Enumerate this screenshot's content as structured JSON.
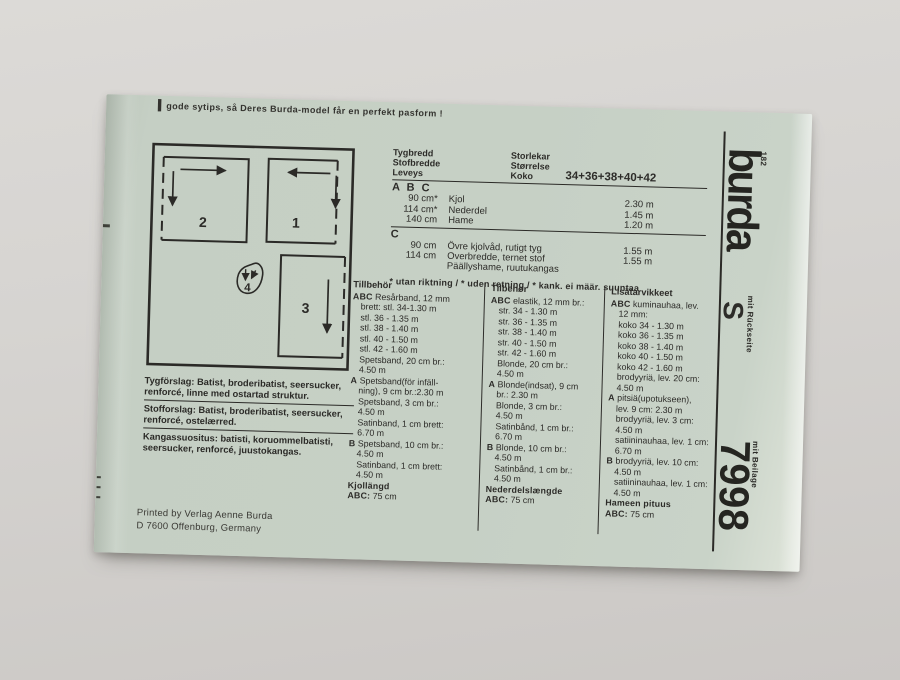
{
  "colors": {
    "background": "#d4d2cf",
    "paper": "#c6d0c5",
    "ink": "#2b2a27"
  },
  "top_note": {
    "lead_mark": "▍",
    "text": "gode sytips, så Deres Burda-model får en perfekt pasform !"
  },
  "layout_diagram": {
    "pieces": [
      "1",
      "2",
      "3",
      "4"
    ]
  },
  "fabric_table": {
    "header_left": [
      "Tygbredd",
      "Stofbredde",
      "Leveys"
    ],
    "header_right": [
      "Storlekar",
      "Størrelse",
      "Koko"
    ],
    "sizes": "34+36+38+40+42",
    "sections": [
      {
        "label": "A B C",
        "rows": [
          [
            "90 cm*",
            "Kjol",
            "2.30 m"
          ],
          [
            "114 cm*",
            "Nederdel",
            "1.45 m"
          ],
          [
            "140 cm",
            "Hame",
            "1.20 m"
          ]
        ]
      },
      {
        "label": "C",
        "rows": [
          [
            "90 cm",
            "Övre kjolvåd, rutigt tyg",
            "1.55 m"
          ],
          [
            "114 cm",
            "Overbredde, ternet stof",
            "1.55 m"
          ],
          [
            "",
            "Päällyshame, ruutukangas",
            ""
          ]
        ]
      }
    ],
    "footnote": "* utan riktning / * uden retning / * kank. ei määr. suuntaa"
  },
  "notions_columns": [
    {
      "title": "Tillbehör",
      "lines": [
        {
          "b": "ABC",
          "t": "Resårband, 12 mm"
        },
        {
          "t": "brett: stl. 34-1.30 m"
        },
        {
          "t": "stl. 36 - 1.35 m"
        },
        {
          "t": "stl. 38 - 1.40 m"
        },
        {
          "t": "stl. 40 - 1.50 m"
        },
        {
          "t": "stl. 42 - 1.60 m"
        },
        {
          "t": "Spetsband, 20 cm br.:"
        },
        {
          "t": "4.50 m"
        },
        {
          "b": "A",
          "t": "Spetsband(för infäll-"
        },
        {
          "t": "ning), 9 cm br.:2.30 m"
        },
        {
          "t": "Spetsband, 3 cm br.:"
        },
        {
          "t": "4.50 m"
        },
        {
          "t": "Satinband, 1 cm brett:"
        },
        {
          "t": "6.70 m"
        },
        {
          "b": "B",
          "t": "Spetsband, 10 cm br.:"
        },
        {
          "t": "4.50 m"
        },
        {
          "t": "Satinband, 1 cm brett:"
        },
        {
          "t": "4.50 m"
        },
        {
          "b": "Kjollängd",
          "t": ""
        },
        {
          "b": "ABC:",
          "t": "75 cm"
        }
      ]
    },
    {
      "title": "Tilbehør",
      "lines": [
        {
          "b": "ABC",
          "t": "elastik, 12 mm br.:"
        },
        {
          "t": "str. 34 - 1.30 m"
        },
        {
          "t": "str. 36 - 1.35 m"
        },
        {
          "t": "str. 38 - 1.40 m"
        },
        {
          "t": "str. 40 - 1.50 m"
        },
        {
          "t": "str. 42 - 1.60 m"
        },
        {
          "t": "Blonde, 20 cm br.:"
        },
        {
          "t": "4.50 m"
        },
        {
          "b": "A",
          "t": "Blonde(indsat), 9 cm"
        },
        {
          "t": "br.: 2.30 m"
        },
        {
          "t": "Blonde, 3 cm br.:"
        },
        {
          "t": "4.50 m"
        },
        {
          "t": "Satinbånd, 1 cm br.:"
        },
        {
          "t": "6.70 m"
        },
        {
          "b": "B",
          "t": "Blonde, 10 cm br.:"
        },
        {
          "t": "4.50 m"
        },
        {
          "t": "Satinbånd, 1 cm br.:"
        },
        {
          "t": "4.50 m"
        },
        {
          "b": "Nederdelslængde",
          "t": ""
        },
        {
          "b": "ABC:",
          "t": "75 cm"
        }
      ]
    },
    {
      "title": "Lisätarvikkeet",
      "lines": [
        {
          "b": "ABC",
          "t": "kuminauhaa, lev."
        },
        {
          "t": "12 mm:"
        },
        {
          "t": "koko 34 - 1.30 m"
        },
        {
          "t": "koko 36 - 1.35 m"
        },
        {
          "t": "koko 38 - 1.40 m"
        },
        {
          "t": "koko 40 - 1.50 m"
        },
        {
          "t": "koko 42 - 1.60 m"
        },
        {
          "t": "brodyyriä, lev. 20 cm:"
        },
        {
          "t": "4.50 m"
        },
        {
          "b": "A",
          "t": "pitsiä(upotukseen),"
        },
        {
          "t": "lev. 9 cm: 2.30 m"
        },
        {
          "t": "brodyyriä, lev. 3 cm:"
        },
        {
          "t": "4.50 m"
        },
        {
          "t": "satiininauhaa, lev. 1 cm:"
        },
        {
          "t": "6.70 m"
        },
        {
          "b": "B",
          "t": "brodyyriä, lev. 10 cm:"
        },
        {
          "t": "4.50 m"
        },
        {
          "t": "satiininauhaa, lev. 1 cm:"
        },
        {
          "t": "4.50 m"
        },
        {
          "b": "Hameen pituus",
          "t": ""
        },
        {
          "b": "ABC:",
          "t": "75 cm"
        }
      ]
    }
  ],
  "fabric_suggestions": [
    {
      "label": "Tygförslag:",
      "text": "Batist, broderibatist, seersucker, renforcé, linne med ostartad struktur.",
      "underline": true
    },
    {
      "label": "Stofforslag:",
      "text": "Batist, broderibatist, seersucker, renforcé, ostelærred.",
      "underline": true
    },
    {
      "label": "Kangassuositus:",
      "text": "batisti, koruommelbatisti, seersucker, renforcé, juustokangas.",
      "underline": false
    }
  ],
  "imprint": [
    "Printed by Verlag Aenne Burda",
    "D 7600 Offenburg, Germany"
  ],
  "brand": {
    "edition": "182",
    "logo": "burda",
    "with_back_label": "mit Rückseite",
    "size_letter": "S",
    "with_insert_label": "mit Beilage",
    "style_number": "7998"
  }
}
